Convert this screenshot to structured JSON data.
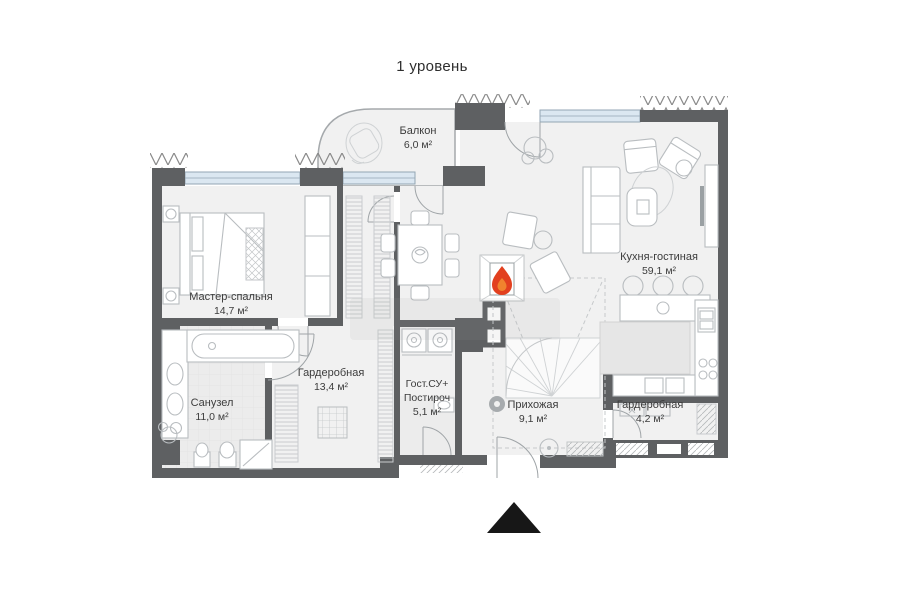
{
  "title": "1 уровень",
  "rooms": {
    "balcony": {
      "name": "Балкон",
      "area": "6,0 м²"
    },
    "master_bedroom": {
      "name": "Мастер-спальня",
      "area": "14,7 м²"
    },
    "kitchen_living": {
      "name": "Кухня-гостиная",
      "area": "59,1 м²"
    },
    "wardrobe_main": {
      "name": "Гардеробная",
      "area": "13,4 м²"
    },
    "bathroom": {
      "name": "Санузел",
      "area": "11,0 м²"
    },
    "guest_wc": {
      "name_line1": "Гост.СУ+",
      "name_line2": "Постироч",
      "area": "5,1 м²"
    },
    "hallway": {
      "name": "Прихожая",
      "area": "9,1 м²"
    },
    "wardrobe_entry": {
      "name": "Гардеробная",
      "area": "4,2 м²"
    }
  },
  "colors": {
    "wall": "#5e6062",
    "glass": "#dbe7f1",
    "room": "#f1f1f1",
    "room_dark": "#ececec",
    "furniture": "#b9bdc0",
    "flame": "#e2401f",
    "flame_inner": "#f0832e",
    "arrow": "#171717",
    "label": "#3c3c3c"
  }
}
